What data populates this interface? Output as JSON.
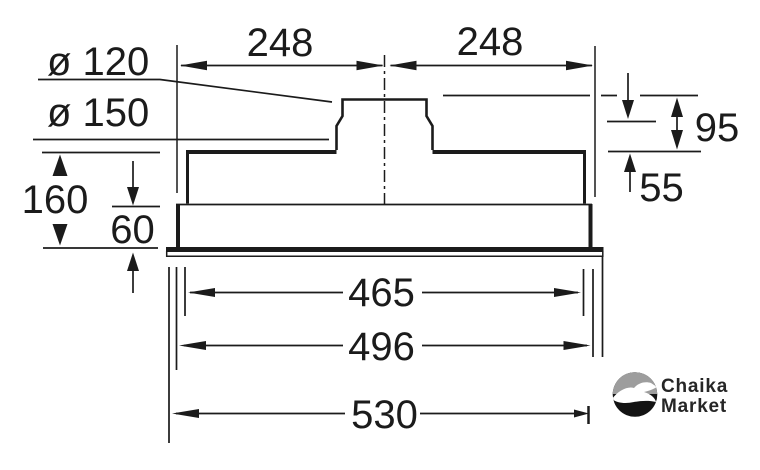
{
  "diagram": {
    "type": "technical-dimension-drawing",
    "subject": "built-in cooker hood side profile with duct collar",
    "labels": {
      "top_width_left": "248",
      "top_width_right": "248",
      "duct_diameter_small": "ø 120",
      "duct_diameter_large": "ø 150",
      "left_height_total": "160",
      "left_height_inner": "60",
      "right_height_upper": "95",
      "right_height_lower": "55",
      "bottom_width_inner": "465",
      "bottom_width_middle": "496",
      "bottom_width_outer": "530"
    },
    "colors": {
      "ink": "#1b1b1b",
      "background": "#ffffff"
    }
  },
  "logo": {
    "text_line1": "Chaika",
    "text_line2": "Market",
    "colors": {
      "sky": "#9d9d9d",
      "sea": "#131313",
      "bird": "#ffffff",
      "text": "#262626"
    }
  }
}
